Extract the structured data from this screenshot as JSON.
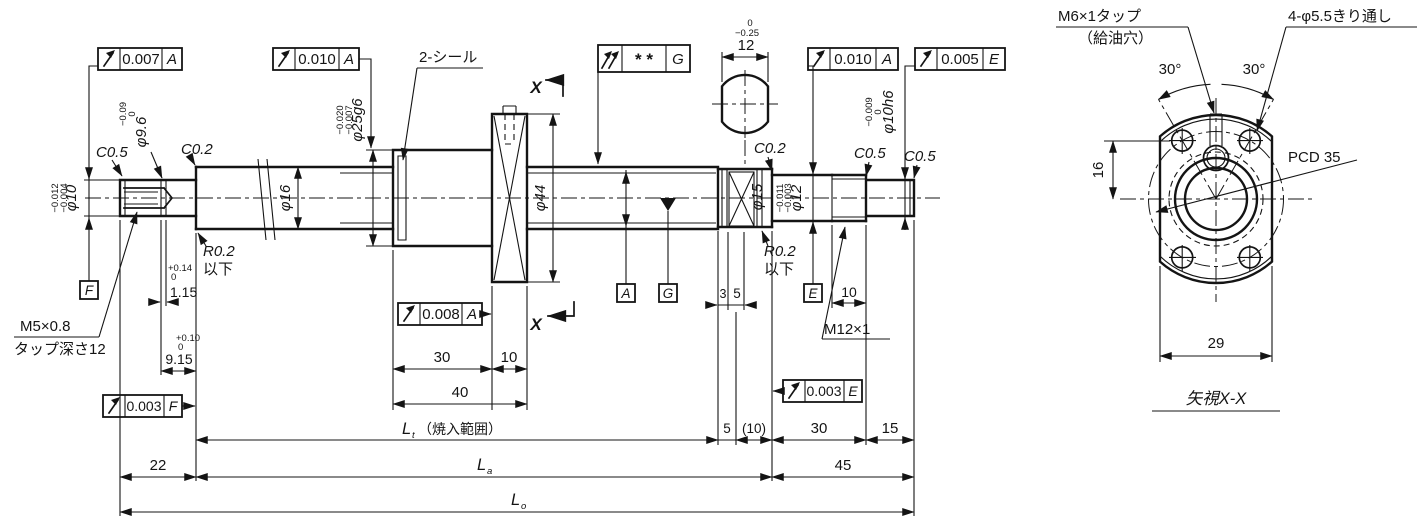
{
  "frames": {
    "f1v": "0.007",
    "f1d": "A",
    "f2v": "0.010",
    "f2d": "A",
    "f3v": "* *",
    "f3d": "G",
    "f4v": "0.010",
    "f4d": "A",
    "f5v": "0.005",
    "f5d": "E",
    "f6v": "0.008",
    "f6d": "A",
    "f7v": "0.003",
    "f7d": "F",
    "f8v": "0.003",
    "f8d": "E"
  },
  "datums": {
    "F": "F",
    "A": "A",
    "G": "G",
    "E": "E"
  },
  "left": {
    "dia10": "φ10",
    "dia10_tol_u": "−0.004",
    "dia10_tol_l": "−0.012",
    "dia96": "φ9.6",
    "dia96_tol_u": "0",
    "dia96_tol_l": "−0.09",
    "c05": "C0.5",
    "c02": "C0.2",
    "r02": "R0.2",
    "r02_note": "以下",
    "tap1": "M5×0.8",
    "tap2": "タップ深さ12",
    "g115": "1.15",
    "g115_tol_u": "+0.14",
    "g115_tol_l": "0",
    "d915": "9.15",
    "d915_tol_u": "+0.10",
    "d915_tol_l": "0",
    "dia16": "φ16"
  },
  "nut": {
    "seal": "2-シール",
    "dia25": "φ25g6",
    "dia25_tol_u": "−0.007",
    "dia25_tol_l": "−0.020",
    "dia44": "φ44",
    "d30": "30",
    "d10": "10",
    "d40": "40"
  },
  "section": {
    "x": "X"
  },
  "right": {
    "flat12": "12",
    "flat12_tol_u": "0",
    "flat12_tol_l": "−0.25",
    "c02": "C0.2",
    "dia15": "φ15",
    "dia12": "φ12",
    "dia12_tol_u": "−0.003",
    "dia12_tol_l": "−0.011",
    "r02": "R0.2",
    "r02_note": "以下",
    "d3": "3",
    "d5": "5",
    "d10": "10",
    "m12": "M12×1",
    "dia10h6": "φ10h6",
    "dia10h6_tol_u": "0",
    "dia10h6_tol_l": "−0.009",
    "c05a": "C0.5",
    "c05b": "C0.5"
  },
  "bottom": {
    "d22": "22",
    "lt": "L",
    "lt_sub": "t",
    "lt_note": "（焼入範囲）",
    "d5": "5",
    "d10p": "(10)",
    "d30": "30",
    "d15": "15",
    "la": "L",
    "la_sub": "a",
    "d45": "45",
    "lo": "L",
    "lo_sub": "o"
  },
  "endview": {
    "m6a": "M6×1タップ",
    "m6b": "（給油穴）",
    "holes": "4-φ5.5きり通し",
    "angL": "30°",
    "angR": "30°",
    "d16": "16",
    "pcd": "PCD 35",
    "d29": "29",
    "title": "矢視X-X"
  }
}
